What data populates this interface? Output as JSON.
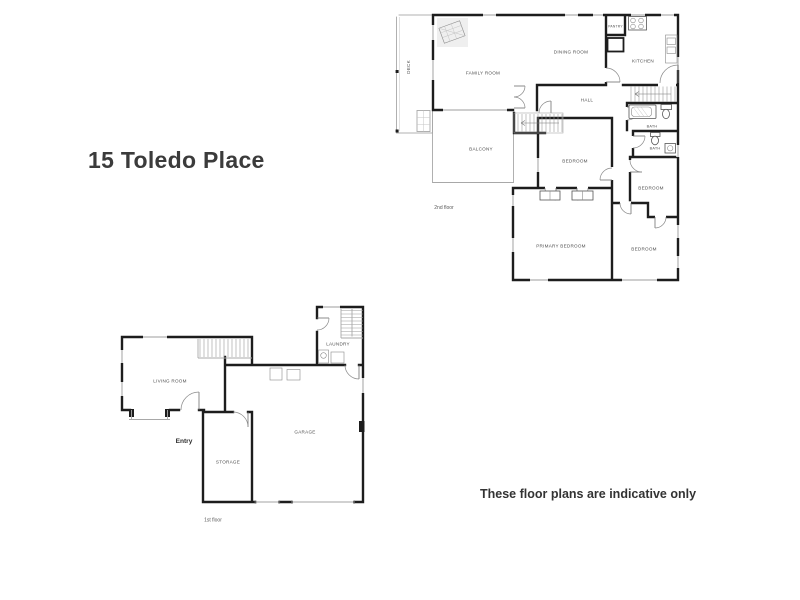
{
  "page": {
    "title": "15 Toledo Place",
    "disclaimer": "These floor plans are indicative only"
  },
  "second_floor": {
    "caption": "2nd floor",
    "rooms": {
      "deck": "DECK",
      "family_room": "FAMILY ROOM",
      "dining_room": "DINING ROOM",
      "pantry": "PANTRY",
      "kitchen": "KITCHEN",
      "hall": "HALL",
      "bath_main": "BATH",
      "bath_ensuite": "BATH",
      "bedroom_middle": "BEDROOM",
      "bedroom_right": "BEDROOM",
      "balcony": "BALCONY",
      "primary_bedroom": "PRIMARY BEDROOM",
      "bedroom_bottom": "BEDROOM"
    }
  },
  "first_floor": {
    "caption": "1st floor",
    "rooms": {
      "living_room": "LIVING ROOM",
      "laundry": "LAUNDRY",
      "storage": "STORAGE",
      "garage": "GARAGE",
      "entry": "Entry"
    }
  },
  "colors": {
    "wall": "#1d1d1d",
    "thin_line": "#a8a8a8",
    "window_line": "#bdbdbd",
    "room_label": "#4f4f4f",
    "title_text": "#3b3b3b"
  }
}
